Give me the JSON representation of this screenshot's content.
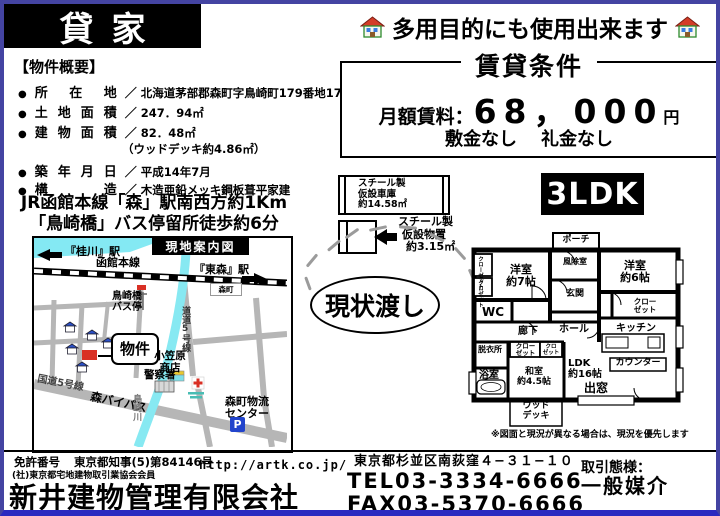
{
  "title": "貸家",
  "tagline": "多用目的にも使用出来ます",
  "rental": {
    "title": "賃貸条件",
    "rent_label": "月額賃料：",
    "rent_value": "68，000",
    "rent_unit": "円",
    "no_deposit": "敷金なし",
    "no_key_money": "礼金なし"
  },
  "overview": {
    "heading": "【物件概要】",
    "bullet": "●",
    "separator": "／",
    "items": [
      {
        "label": "所在地",
        "value": "北海道茅部郡森町字鳥崎町179番地17"
      },
      {
        "label": "土地面積",
        "value": "247．94㎡"
      },
      {
        "label": "建物面積",
        "value": "82．48㎡"
      },
      {
        "label": "",
        "value": "（ウッドデッキ約4.86㎡）"
      },
      {
        "label": "築年月日",
        "value": "平成14年7月"
      },
      {
        "label": "構造",
        "value": "木造亜鉛メッキ鋼板葺平家建"
      }
    ]
  },
  "access": {
    "line1": "JR函館本線「森」駅南西方約1Km",
    "line2": "「鳥崎橋」バス停留所徒歩約6分"
  },
  "map": {
    "title": "現地案内図",
    "station_left": "『桂川』駅",
    "rail_line": "函館本線",
    "station_right": "『東森』駅",
    "town_label": "森町",
    "bus_stop_line1": "鳥崎橋",
    "bus_stop_line2": "バス停",
    "property_label": "物件",
    "store_line1": "小笠原",
    "store_line2": "商店",
    "police": "警察署",
    "pref_road": "道道5号線",
    "national_road": "国道5号線",
    "bypass": "森バイパス",
    "river": "鳥崎川",
    "logistics_line1": "森町物流",
    "logistics_line2": "センター",
    "parking": "P"
  },
  "garage": {
    "line1": "スチール製",
    "line2": "仮設車庫",
    "line3": "約14.58㎡"
  },
  "shed": {
    "line1": "スチール製",
    "line2": "仮設物置",
    "line3": "約3.15㎡"
  },
  "layout_badge": "3LDK",
  "as_is": "現状渡し",
  "floorplan": {
    "porch": "ポーチ",
    "windbreak": "風除室",
    "entrance": "玄関",
    "hall": "ホール",
    "west7_line1": "洋室",
    "west7_line2": "約7帖",
    "west6_line1": "洋室",
    "west6_line2": "約6帖",
    "closet_vertical": "クローゼット",
    "closet_vertical2": "クロゼット",
    "closet_line1": "クロー",
    "closet_line2": "ゼット",
    "closet_small_line1": "クロ",
    "closet_small_line2": "ゼット",
    "wc": "WC",
    "corridor": "廊下",
    "dressing": "脱衣所",
    "bath": "浴室",
    "washitsu_line1": "和室",
    "washitsu_line2": "約4.5帖",
    "ldk_line1": "LDK",
    "ldk_line2": "約16帖",
    "kitchen": "キッチン",
    "counter": "カウンター",
    "bay_window": "出窓",
    "deck_line1": "ウッド",
    "deck_line2": "デッキ",
    "note": "※図面と現況が異なる場合は、現況を優先します"
  },
  "footer": {
    "license_label": "免許番号",
    "license_number": "東京都知事(5)第84146号",
    "membership": "(社)東京都宅地建物取引業協会会員",
    "company": "新井建物管理有限会社",
    "url": "http://artk.co.jp/",
    "address": "東京都杉並区南荻窪４−３１−１０",
    "tel": "TEL03-3334-6666",
    "fax": "FAX03-5370-6666",
    "dealing_label": "取引態様：",
    "dealing_type": "一般媒介"
  }
}
